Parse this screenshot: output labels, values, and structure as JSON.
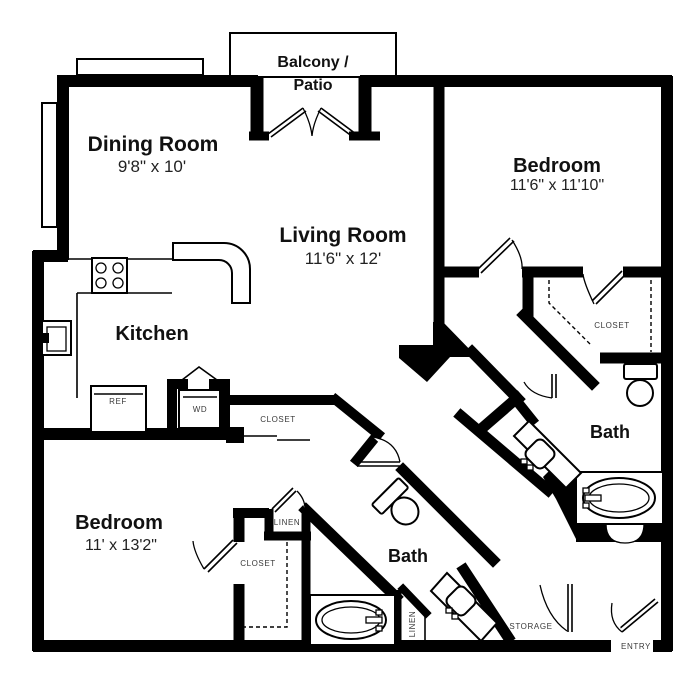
{
  "rooms": {
    "balcony": {
      "name_line1": "Balcony /",
      "name_line2": "Patio"
    },
    "dining": {
      "name": "Dining Room",
      "dims": "9'8\" x 10'"
    },
    "living": {
      "name": "Living Room",
      "dims": "11'6\" x 12'"
    },
    "kitchen": {
      "name": "Kitchen"
    },
    "bedroom1": {
      "name": "Bedroom",
      "dims": "11'6\" x 11'10\""
    },
    "bedroom2": {
      "name": "Bedroom",
      "dims": "11' x 13'2\""
    },
    "bath1": {
      "name": "Bath"
    },
    "bath2": {
      "name": "Bath"
    }
  },
  "labels": {
    "closet_hall": "CLOSET",
    "closet_bedroom1": "CLOSET",
    "closet_bedroom2": "CLOSET",
    "linen_bedroom": "LINEN",
    "linen_bath": "LINEN",
    "storage": "STORAGE",
    "entry": "ENTRY",
    "ref": "REF",
    "wd": "WD"
  },
  "colors": {
    "wall": "#000000",
    "background": "#ffffff",
    "room_text": "#111111",
    "small_text": "#3a3a3a"
  }
}
